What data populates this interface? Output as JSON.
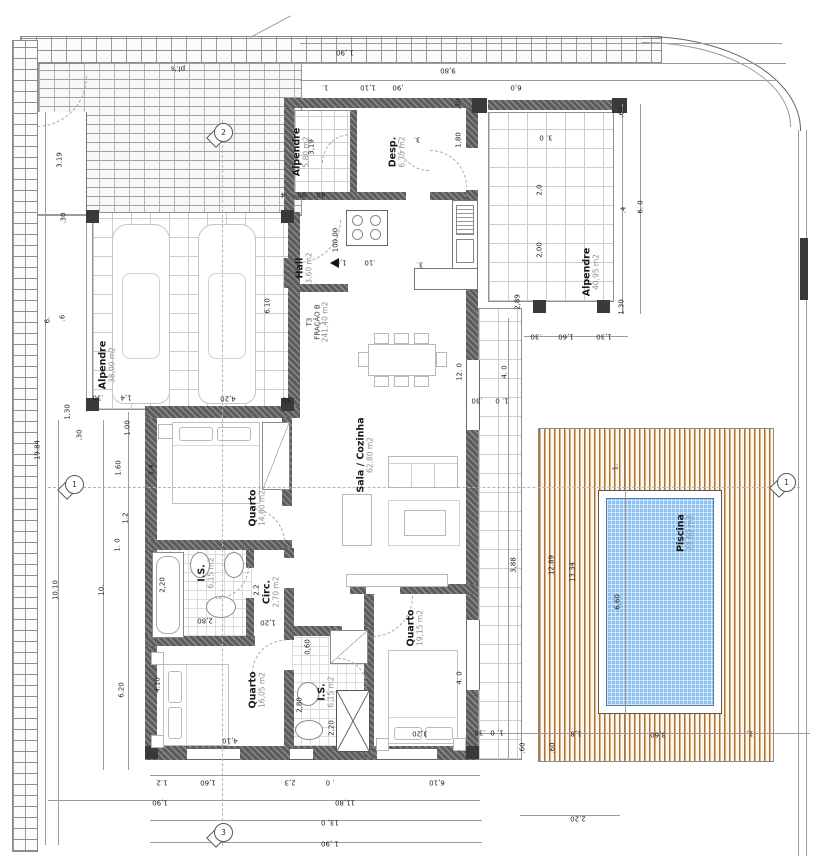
{
  "drawing": {
    "type": "architectural floor plan",
    "language": "pt"
  },
  "colors": {
    "wall": "#5c5c5c",
    "post": "#3a3a3a",
    "pool_water": "#8cc0ee",
    "deck_stripe": "#b0702c",
    "brick_line": "#8f8f8f",
    "tile_line": "#cdcdcd",
    "dim_text": "#1f1f1f"
  },
  "fraction": {
    "code": "T3",
    "name": "FRAÇÃO B",
    "area": "241,40 m2"
  },
  "rooms": [
    {
      "name": "Alpendre",
      "area": "38,00 m2"
    },
    {
      "name": "Alpendre",
      "area": "5,80 m2"
    },
    {
      "name": "Desp.",
      "area": "6,75 m2"
    },
    {
      "name": "Hall",
      "area": "3,60 m2"
    },
    {
      "name": "Sala / Cozinha",
      "area": "62,80 m2"
    },
    {
      "name": "Quarto",
      "area": "14,60 m2"
    },
    {
      "name": "I.S.",
      "area": "6,15 m2"
    },
    {
      "name": "Circ.",
      "area": "2,70 m2"
    },
    {
      "name": "Quarto",
      "area": "16,05 m2"
    },
    {
      "name": "I.S.",
      "area": "6,15 m2"
    },
    {
      "name": "Quarto",
      "area": "19,15 m2"
    },
    {
      "name": "Alpendre",
      "area": "40,95 m2"
    },
    {
      "name": "Piscina",
      "area": "23,60 m2"
    }
  ],
  "markers": {
    "top": "2",
    "left": "1",
    "right": "1",
    "bottom": "3"
  },
  "level_marker": "100.00",
  "dimensions": [
    {
      "t": "1 ,90",
      "x": 345,
      "y": 52,
      "r": 180
    },
    {
      "t": "9,80",
      "x": 448,
      "y": 70,
      "r": 180
    },
    {
      "t": "1.",
      "x": 325,
      "y": 87,
      "r": 180
    },
    {
      "t": "1,10",
      "x": 368,
      "y": 87,
      "r": 180
    },
    {
      "t": ",90",
      "x": 398,
      "y": 87,
      "r": 180
    },
    {
      "t": "6,0",
      "x": 516,
      "y": 87,
      "r": 180
    },
    {
      "t": "pl.'s",
      "x": 178,
      "y": 68,
      "r": 180
    },
    {
      "t": "3.19",
      "x": 60,
      "y": 160,
      "r": 270
    },
    {
      "t": ".30",
      "x": 64,
      "y": 218,
      "r": 270
    },
    {
      "t": "3,19",
      "x": 312,
      "y": 147,
      "r": 270
    },
    {
      "t": ".4",
      "x": 284,
      "y": 194,
      "r": 180
    },
    {
      "t": ".90",
      "x": 303,
      "y": 194,
      "r": 180
    },
    {
      "t": ".40",
      "x": 322,
      "y": 194,
      "r": 180
    },
    {
      "t": ".30",
      "x": 459,
      "y": 104,
      "r": 270
    },
    {
      "t": "1,80",
      "x": 459,
      "y": 140,
      "r": 270
    },
    {
      "t": "3.",
      "x": 417,
      "y": 139,
      "r": 180
    },
    {
      "t": ".60",
      "x": 622,
      "y": 112,
      "r": 270
    },
    {
      "t": "3. 0",
      "x": 546,
      "y": 137,
      "r": 180
    },
    {
      "t": "2,0",
      "x": 540,
      "y": 190,
      "r": 270
    },
    {
      "t": "2,00",
      "x": 540,
      "y": 250,
      "r": 270
    },
    {
      "t": ".4",
      "x": 624,
      "y": 210,
      "r": 270
    },
    {
      "t": "6. 0",
      "x": 641,
      "y": 207,
      "r": 270
    },
    {
      "t": "2,89",
      "x": 518,
      "y": 302,
      "r": 270
    },
    {
      "t": "1.30",
      "x": 622,
      "y": 307,
      "r": 270
    },
    {
      "t": ".30",
      "x": 536,
      "y": 336,
      "r": 180
    },
    {
      "t": "1,60",
      "x": 566,
      "y": 336,
      "r": 180
    },
    {
      "t": "1,30",
      "x": 604,
      "y": 336,
      "r": 180
    },
    {
      "t": "6.10",
      "x": 268,
      "y": 306,
      "r": 270
    },
    {
      "t": "6.",
      "x": 48,
      "y": 320,
      "r": 270
    },
    {
      "t": ".6",
      "x": 63,
      "y": 318,
      "r": 270
    },
    {
      "t": ".30",
      "x": 98,
      "y": 397,
      "r": 180
    },
    {
      "t": "1,4",
      "x": 126,
      "y": 397,
      "r": 180
    },
    {
      "t": "4,20",
      "x": 228,
      "y": 398,
      "r": 180
    },
    {
      "t": ".30",
      "x": 288,
      "y": 399,
      "r": 180
    },
    {
      "t": "1,30",
      "x": 68,
      "y": 412,
      "r": 270
    },
    {
      "t": ".30",
      "x": 80,
      "y": 435,
      "r": 270
    },
    {
      "t": "1.00",
      "x": 128,
      "y": 428,
      "r": 270
    },
    {
      "t": "1.60",
      "x": 119,
      "y": 468,
      "r": 270
    },
    {
      "t": "1.2",
      "x": 126,
      "y": 518,
      "r": 270
    },
    {
      "t": "1. 0",
      "x": 118,
      "y": 545,
      "r": 270
    },
    {
      "t": "19.84",
      "x": 38,
      "y": 450,
      "r": 270
    },
    {
      "t": "10.10",
      "x": 56,
      "y": 590,
      "r": 270
    },
    {
      "t": "10.",
      "x": 102,
      "y": 590,
      "r": 270
    },
    {
      "t": "6.20",
      "x": 122,
      "y": 690,
      "r": 270
    },
    {
      "t": "3.4",
      "x": 152,
      "y": 470,
      "r": 270
    },
    {
      "t": "2,20",
      "x": 163,
      "y": 585,
      "r": 270
    },
    {
      "t": "4.10",
      "x": 158,
      "y": 685,
      "r": 270
    },
    {
      "t": "100.00",
      "x": 336,
      "y": 240,
      "r": 270
    },
    {
      "t": "1,6",
      "x": 341,
      "y": 262,
      "r": 180
    },
    {
      "t": ".10",
      "x": 370,
      "y": 262,
      "r": 180
    },
    {
      "t": "3.",
      "x": 420,
      "y": 264,
      "r": 180
    },
    {
      "t": "12. 0",
      "x": 460,
      "y": 372,
      "r": 270
    },
    {
      "t": "2,80",
      "x": 205,
      "y": 620,
      "r": 180
    },
    {
      "t": "1,20",
      "x": 268,
      "y": 622,
      "r": 180
    },
    {
      "t": "2.2",
      "x": 257,
      "y": 590,
      "r": 270
    },
    {
      "t": "0,60",
      "x": 308,
      "y": 647,
      "r": 270
    },
    {
      "t": "2,80",
      "x": 300,
      "y": 705,
      "r": 270
    },
    {
      "t": "2,20",
      "x": 332,
      "y": 728,
      "r": 270
    },
    {
      "t": "3,20",
      "x": 420,
      "y": 733,
      "r": 180
    },
    {
      "t": "4,10",
      "x": 230,
      "y": 740,
      "r": 180
    },
    {
      "t": "4. 0",
      "x": 460,
      "y": 678,
      "r": 270
    },
    {
      "t": "3,88",
      "x": 514,
      "y": 565,
      "r": 270
    },
    {
      "t": "4. 0",
      "x": 505,
      "y": 372,
      "r": 270
    },
    {
      "t": ".30",
      "x": 477,
      "y": 400,
      "r": 180
    },
    {
      "t": "1. 0",
      "x": 502,
      "y": 400,
      "r": 180
    },
    {
      "t": ".30",
      "x": 480,
      "y": 732,
      "r": 180
    },
    {
      "t": "1. 0",
      "x": 497,
      "y": 732,
      "r": 180
    },
    {
      "t": ".60",
      "x": 523,
      "y": 748,
      "r": 270
    },
    {
      "t": ".60",
      "x": 553,
      "y": 748,
      "r": 270
    },
    {
      "t": "1,8",
      "x": 576,
      "y": 733,
      "r": 180
    },
    {
      "t": "3,60",
      "x": 658,
      "y": 734,
      "r": 180
    },
    {
      "t": "1,",
      "x": 750,
      "y": 733,
      "r": 180
    },
    {
      "t": "2,20",
      "x": 578,
      "y": 818,
      "r": 180
    },
    {
      "t": "12.89",
      "x": 552,
      "y": 565,
      "r": 270
    },
    {
      "t": "13.34",
      "x": 573,
      "y": 572,
      "r": 270
    },
    {
      "t": "6,60",
      "x": 618,
      "y": 602,
      "r": 270
    },
    {
      "t": "1.",
      "x": 616,
      "y": 467,
      "r": 270
    },
    {
      "t": "1.2",
      "x": 162,
      "y": 782,
      "r": 180
    },
    {
      "t": "1,60",
      "x": 208,
      "y": 782,
      "r": 180
    },
    {
      "t": "2,3",
      "x": 290,
      "y": 782,
      "r": 180
    },
    {
      "t": ". 0",
      "x": 330,
      "y": 782,
      "r": 180
    },
    {
      "t": "6,10",
      "x": 437,
      "y": 782,
      "r": 180
    },
    {
      "t": "1,90",
      "x": 160,
      "y": 802,
      "r": 180
    },
    {
      "t": "11,80",
      "x": 345,
      "y": 802,
      "r": 180
    },
    {
      "t": "13, 0",
      "x": 330,
      "y": 822,
      "r": 180
    },
    {
      "t": "1 ,90",
      "x": 330,
      "y": 843,
      "r": 180
    }
  ]
}
